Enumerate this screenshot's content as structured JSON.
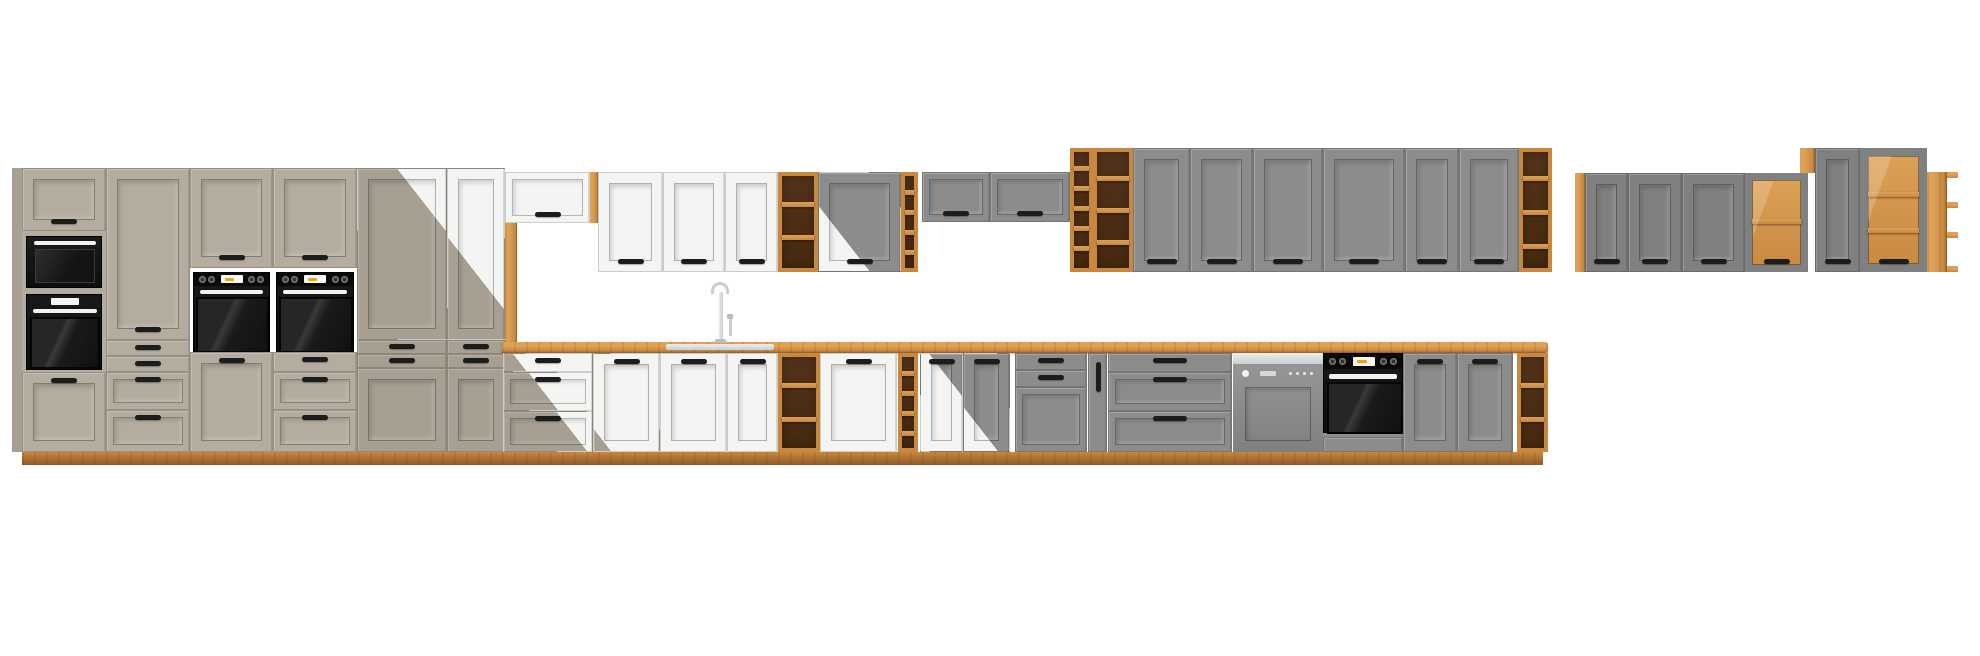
{
  "scene": {
    "type": "product-render",
    "subject": "Modular kitchen cabinet lineup, front elevation on white background",
    "finishes": [
      "clay grey",
      "white",
      "dust grey",
      "artisan oak"
    ]
  },
  "colors": {
    "bg": "#ffffff",
    "clay": "#b4ad9f",
    "clayDk": "#a69f92",
    "white": "#f4f4f3",
    "grey": "#8c8c8c",
    "greyD": "#7e8081",
    "oakHi": "#dda257",
    "oakMid": "#c8883f",
    "oakLo": "#8e5a26",
    "oakCell": "#45290f",
    "handle": "#1c1c1c",
    "steel": "#c9cdd0",
    "amber": "#f2a500"
  },
  "groups": [
    {
      "name": "tall-run-clay",
      "modules": [
        "tall unit with flap door, microwave, oven and door",
        "larder with tall door and four drawers",
        "tall oven unit with two doors",
        "tall oven unit with door and three drawers",
        "larder clay-to-white transition",
        "larder white-to-clay transition"
      ]
    },
    {
      "name": "white-wall-run",
      "modules": [
        "over-fridge flap cabinet with oak side panels",
        "three wall doors",
        "oak open wall shelf",
        "wall door white-to-grey transition",
        "oak wall wine rack",
        "two grey flap wall cabinets"
      ]
    },
    {
      "name": "grey-wall-run",
      "modules": [
        "oak open shelf with wine rack column",
        "six grey wall doors",
        "oak open end shelf"
      ]
    },
    {
      "name": "base-run",
      "modules": [
        "three-drawer base transition",
        "three white base doors with sink and tap",
        "oak open base shelf",
        "white base door",
        "oak base wine rack",
        "two base doors white-to-grey transition",
        "grey base with two drawers and door",
        "narrow pull-out cargo",
        "three-drawer grey base",
        "semi-integrated dishwasher",
        "built-in black oven housing",
        "two grey base doors",
        "oak open base end shelf",
        "oak worktop",
        "oak plinth"
      ]
    },
    {
      "name": "far-right-wall-group",
      "modules": [
        "oak side strip",
        "three grey wall doors",
        "glass wall cabinet with oak shelf",
        "oak top block",
        "tall grey wall door",
        "tall glass display cabinet with oak shelves",
        "oak open corner shelf"
      ]
    }
  ]
}
